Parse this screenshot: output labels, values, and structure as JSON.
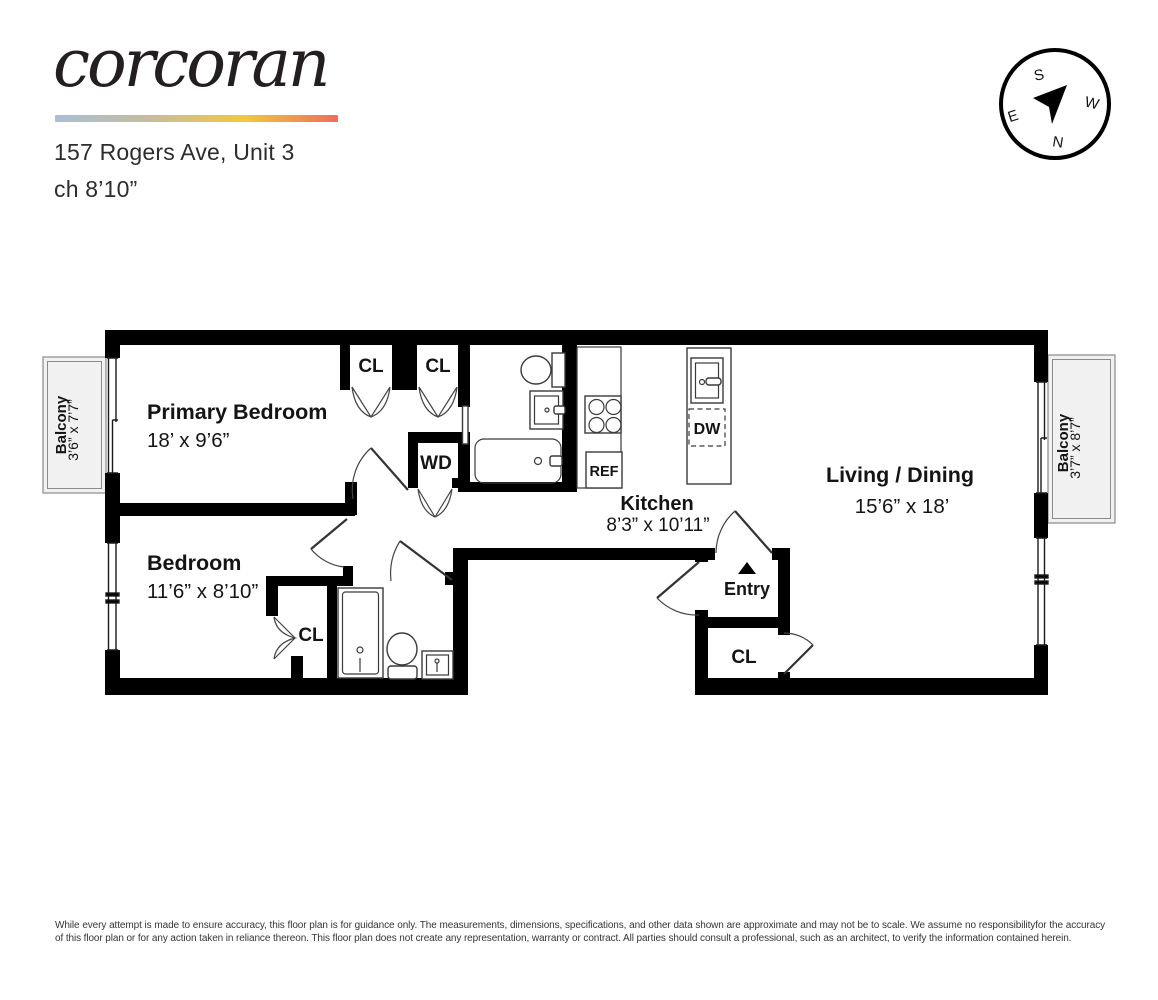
{
  "header": {
    "brand": "corcoran",
    "address": "157 Rogers Ave, Unit 3",
    "ceiling_height": "ch 8’10”",
    "gradient_colors": [
      "#a9bfd6",
      "#c6bc9e",
      "#f2c83e",
      "#ee6e5c"
    ]
  },
  "compass": {
    "top": "S",
    "right": "W",
    "bottom": "N",
    "left": "E"
  },
  "rooms": {
    "primary_bedroom": {
      "name": "Primary Bedroom",
      "dims": "18’ x 9’6”"
    },
    "bedroom": {
      "name": "Bedroom",
      "dims": "11’6” x 8’10”"
    },
    "kitchen": {
      "name": "Kitchen",
      "dims": "8’3” x 10’11”"
    },
    "living_dining": {
      "name": "Living / Dining",
      "dims": "15’6” x 18’"
    },
    "balcony_left": {
      "name": "Balcony",
      "dims": "3’6” x 7’7”"
    },
    "balcony_right": {
      "name": "Balcony",
      "dims": "3’7” x 8’7”"
    },
    "entry": {
      "name": "Entry"
    }
  },
  "labels": {
    "closet": "CL",
    "washer_dryer": "WD",
    "refrigerator": "REF",
    "dishwasher": "DW"
  },
  "footer": {
    "disclaimer": "While every attempt is made to ensure accuracy, this floor plan is for guidance only. The measurements, dimensions, specifications, and other data shown are approximate and may not be to scale. We assume no responsibilityfor the accuracy of this floor plan or for any action taken in reliance thereon. This floor plan does not create any representation, warranty or contract. All parties should consult a professional, such as an architect, to verify the information contained herein."
  }
}
